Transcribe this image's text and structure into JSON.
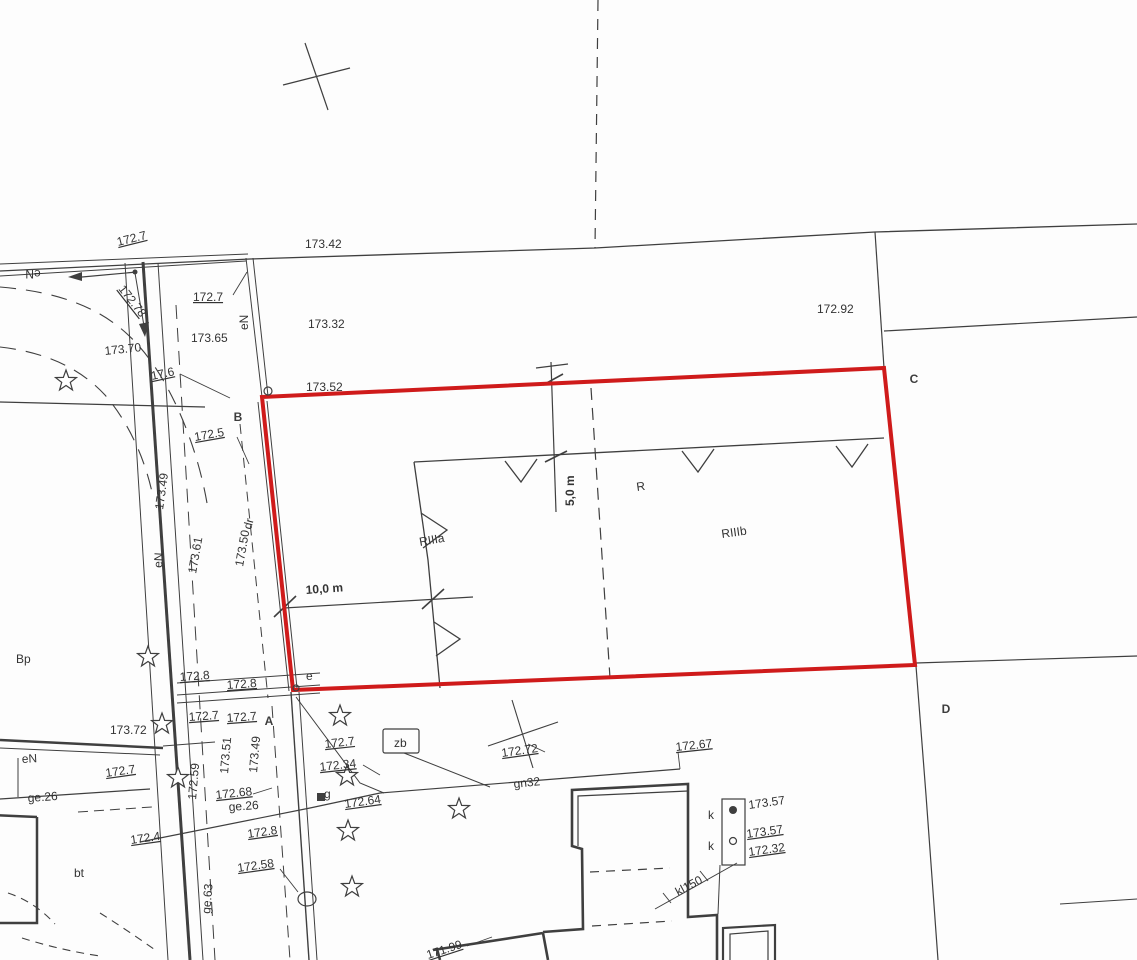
{
  "map": {
    "kind": "cadastral survey map (scan)",
    "colors": {
      "boundary_red": "#cf1b1b",
      "ink": "#3f3f3f",
      "label": "#333333",
      "background": "#fdfdfd"
    },
    "plot_corners": [
      "A",
      "B",
      "C",
      "D"
    ],
    "dimensions_shown": [
      "10,0 m",
      "5,0 m"
    ],
    "landuse_codes": [
      "RIIIa",
      "RIIIb",
      "R",
      "Bp",
      "dr",
      "bt"
    ],
    "utility_codes": [
      "gn32",
      "kl150",
      "ge.63",
      "ge.26",
      "eN",
      "k",
      "zb"
    ]
  },
  "labels": [
    {
      "name": "elev-label",
      "text": "172.7",
      "x": 118,
      "y": 246,
      "rot": -14,
      "fs": 13,
      "u": true
    },
    {
      "name": "elev-label",
      "text": "173.42",
      "x": 305,
      "y": 248,
      "fs": 13
    },
    {
      "name": "utility-label",
      "text": "eN",
      "x": 33,
      "y": 270,
      "rot": 180,
      "fs": 13,
      "anchor": "middle"
    },
    {
      "name": "elev-label",
      "text": "172.78",
      "x": 118,
      "y": 289,
      "rot": 52,
      "fs": 13,
      "u": true
    },
    {
      "name": "elev-label",
      "text": "172.7",
      "x": 193,
      "y": 301,
      "fs": 13,
      "u": true
    },
    {
      "name": "elev-label",
      "text": "173.65",
      "x": 191,
      "y": 342,
      "fs": 13
    },
    {
      "name": "elev-label",
      "text": "173.32",
      "x": 308,
      "y": 328,
      "fs": 13
    },
    {
      "name": "elev-label",
      "text": "173.70",
      "x": 105,
      "y": 355,
      "rot": -6,
      "fs": 13
    },
    {
      "name": "elev-label",
      "text": "17.6",
      "x": 152,
      "y": 380,
      "rot": -12,
      "fs": 13,
      "u": true
    },
    {
      "name": "utility-label",
      "text": "eN",
      "x": 248,
      "y": 330,
      "rot": -90,
      "fs": 12
    },
    {
      "name": "elev-label",
      "text": "172.92",
      "x": 817,
      "y": 313,
      "fs": 13
    },
    {
      "name": "elev-label",
      "text": "173.52",
      "x": 306,
      "y": 391,
      "fs": 13
    },
    {
      "name": "elev-label",
      "text": "172.5",
      "x": 195,
      "y": 441,
      "rot": -10,
      "fs": 13,
      "u": true
    },
    {
      "name": "elev-label",
      "text": "173.49",
      "x": 163,
      "y": 510,
      "rot": -82,
      "fs": 12
    },
    {
      "name": "elev-label",
      "text": "173.61",
      "x": 196,
      "y": 574,
      "rot": -80,
      "fs": 12
    },
    {
      "name": "elev-label",
      "text": "173.50",
      "x": 243,
      "y": 567,
      "rot": -80,
      "fs": 12
    },
    {
      "name": "landuse-label",
      "text": "dr",
      "x": 251,
      "y": 530,
      "rot": -75,
      "fs": 14
    },
    {
      "name": "utility-label",
      "text": "eN",
      "x": 162,
      "y": 568,
      "rot": -87,
      "fs": 11
    },
    {
      "name": "landuse-label",
      "text": "RIIIa",
      "x": 420,
      "y": 546,
      "rot": -10,
      "fs": 22
    },
    {
      "name": "dimension-label",
      "text": "5,0 m",
      "x": 574,
      "y": 506,
      "rot": -90,
      "fs": 16,
      "b": true
    },
    {
      "name": "landuse-label",
      "text": "R",
      "x": 637,
      "y": 491,
      "rot": -8,
      "fs": 22
    },
    {
      "name": "landuse-label",
      "text": "RIIIb",
      "x": 722,
      "y": 538,
      "rot": -8,
      "fs": 22
    },
    {
      "name": "dimension-label",
      "text": "10,0 m",
      "x": 306,
      "y": 594,
      "rot": -4,
      "fs": 16,
      "b": true
    },
    {
      "name": "landuse-label",
      "text": "Bp",
      "x": 16,
      "y": 663,
      "fs": 20
    },
    {
      "name": "elev-label",
      "text": "172.8",
      "x": 180,
      "y": 681,
      "rot": -4,
      "fs": 12,
      "u": true
    },
    {
      "name": "elev-label",
      "text": "172.8",
      "x": 227,
      "y": 689,
      "rot": -4,
      "fs": 12,
      "u": true
    },
    {
      "name": "elev-label",
      "text": "172.7",
      "x": 189,
      "y": 721,
      "rot": -4,
      "fs": 12,
      "u": true
    },
    {
      "name": "elev-label",
      "text": "172.7",
      "x": 227,
      "y": 722,
      "rot": -4,
      "fs": 12,
      "u": true
    },
    {
      "name": "elev-label",
      "text": "173.72",
      "x": 110,
      "y": 734,
      "fs": 12
    },
    {
      "name": "survey-point-label",
      "text": "e",
      "x": 306,
      "y": 680,
      "fs": 9
    },
    {
      "name": "utility-label",
      "text": "eN",
      "x": 22,
      "y": 763,
      "rot": -3,
      "fs": 12
    },
    {
      "name": "elev-label",
      "text": "172.7",
      "x": 106,
      "y": 777,
      "rot": -8,
      "fs": 12,
      "u": true
    },
    {
      "name": "utility-label",
      "text": "ge.26",
      "x": 28,
      "y": 802,
      "rot": -4,
      "fs": 12
    },
    {
      "name": "elev-label",
      "text": "173.51",
      "x": 228,
      "y": 774,
      "rot": -85,
      "fs": 12
    },
    {
      "name": "elev-label",
      "text": "172.59",
      "x": 196,
      "y": 800,
      "rot": -85,
      "fs": 12
    },
    {
      "name": "elev-label",
      "text": "173.49",
      "x": 257,
      "y": 773,
      "rot": -85,
      "fs": 12
    },
    {
      "name": "elev-label",
      "text": "172.7",
      "x": 325,
      "y": 748,
      "rot": -6,
      "fs": 12,
      "u": true
    },
    {
      "name": "elev-label",
      "text": "172.34",
      "x": 320,
      "y": 771,
      "rot": -6,
      "fs": 12,
      "u": true
    },
    {
      "name": "utility-label",
      "text": "g",
      "x": 324,
      "y": 798,
      "fs": 12
    },
    {
      "name": "elev-label",
      "text": "172.68",
      "x": 216,
      "y": 799,
      "rot": -6,
      "fs": 12,
      "u": true
    },
    {
      "name": "utility-label",
      "text": "ge.26",
      "x": 229,
      "y": 811,
      "rot": -4,
      "fs": 12
    },
    {
      "name": "elev-label",
      "text": "172.64",
      "x": 345,
      "y": 808,
      "rot": -8,
      "fs": 12,
      "u": true
    },
    {
      "name": "elev-label",
      "text": "172.72",
      "x": 502,
      "y": 757,
      "rot": -8,
      "fs": 12,
      "u": true
    },
    {
      "name": "utility-label",
      "text": "gn32",
      "x": 514,
      "y": 788,
      "rot": -6,
      "fs": 13
    },
    {
      "name": "elev-label",
      "text": "172.67",
      "x": 676,
      "y": 751,
      "rot": -6,
      "fs": 12,
      "u": true
    },
    {
      "name": "utility-label",
      "text": "k",
      "x": 708,
      "y": 819,
      "fs": 12
    },
    {
      "name": "utility-label",
      "text": "k",
      "x": 708,
      "y": 850,
      "fs": 12
    },
    {
      "name": "elev-label",
      "text": "173.57",
      "x": 749,
      "y": 809,
      "rot": -8,
      "fs": 12
    },
    {
      "name": "elev-label",
      "text": "173.57",
      "x": 747,
      "y": 838,
      "rot": -8,
      "fs": 12,
      "u": true
    },
    {
      "name": "elev-label",
      "text": "172.32",
      "x": 749,
      "y": 856,
      "rot": -8,
      "fs": 12,
      "u": true
    },
    {
      "name": "utility-label",
      "text": "kl150",
      "x": 678,
      "y": 896,
      "rot": -28,
      "fs": 12
    },
    {
      "name": "elev-label",
      "text": "172.4",
      "x": 131,
      "y": 844,
      "rot": -8,
      "fs": 12,
      "u": true
    },
    {
      "name": "elev-label",
      "text": "172.8",
      "x": 248,
      "y": 838,
      "rot": -8,
      "fs": 12,
      "u": true
    },
    {
      "name": "elev-label",
      "text": "172.58",
      "x": 238,
      "y": 872,
      "rot": -8,
      "fs": 12,
      "u": true
    },
    {
      "name": "utility-label",
      "text": "ge.63",
      "x": 210,
      "y": 914,
      "rot": -85,
      "fs": 12
    },
    {
      "name": "landuse-label",
      "text": "bt",
      "x": 74,
      "y": 877,
      "fs": 13
    },
    {
      "name": "elev-label",
      "text": "171.99",
      "x": 428,
      "y": 959,
      "rot": -18,
      "fs": 12,
      "u": true
    },
    {
      "name": "utility-label",
      "text": "zb",
      "x": 394,
      "y": 747,
      "fs": 11
    },
    {
      "name": "corner-label-b",
      "text": "B",
      "x": 238,
      "y": 421,
      "fs": 42,
      "b": true,
      "anchor": "middle",
      "cls": "corner"
    },
    {
      "name": "corner-label-c",
      "text": "C",
      "x": 914,
      "y": 383,
      "fs": 42,
      "b": true,
      "anchor": "middle",
      "cls": "corner"
    },
    {
      "name": "corner-label-a",
      "text": "A",
      "x": 269,
      "y": 725,
      "fs": 42,
      "b": true,
      "anchor": "middle",
      "cls": "corner"
    },
    {
      "name": "corner-label-d",
      "text": "D",
      "x": 946,
      "y": 713,
      "fs": 42,
      "b": true,
      "anchor": "middle",
      "cls": "corner"
    }
  ]
}
